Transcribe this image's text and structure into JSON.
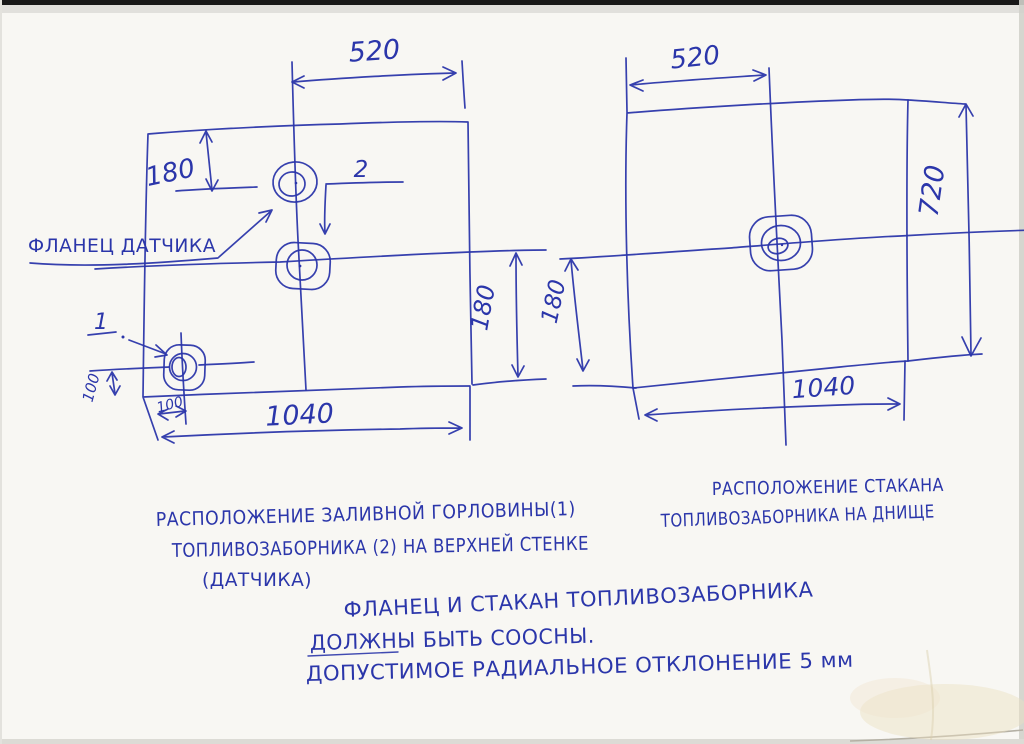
{
  "paper": {
    "background": "#f8f7f3",
    "ink": "#2b36aa"
  },
  "left_view": {
    "dims": {
      "top_width": "520",
      "left_height": "180",
      "right_height": "180",
      "bottom_width": "1040",
      "filler_from_bottom": "100",
      "filler_from_edge": "100"
    },
    "callouts": {
      "flange_label": "ФЛАНЕЦ ДАТЧИКА",
      "item1": "1",
      "item2": "2"
    },
    "caption": {
      "line1": "РАСПОЛОЖЕНИЕ ЗАЛИВНОЙ ГОРЛОВИНЫ(1)",
      "line2": "ТОПЛИВОЗАБОРНИКА (2) НА ВЕРХНЕЙ СТЕНКЕ",
      "line3": "(ДАТЧИКА)"
    }
  },
  "right_view": {
    "dims": {
      "top_width": "520",
      "left_height": "180",
      "right_height": "720",
      "bottom_width": "1040"
    },
    "caption": {
      "line1": "РАСПОЛОЖЕНИЕ СТАКАНА",
      "line2": "ТОПЛИВОЗАБОРНИКА НА ДНИЩЕ"
    }
  },
  "notes": {
    "line1": "ФЛАНЕЦ И СТАКАН ТОПЛИВОЗАБОРНИКА",
    "line2": "ДОЛЖНЫ БЫТЬ СООСНЫ.",
    "line3": "ДОПУСТИМОЕ РАДИАЛЬНОЕ ОТКЛОНЕНИЕ 5 мм"
  }
}
